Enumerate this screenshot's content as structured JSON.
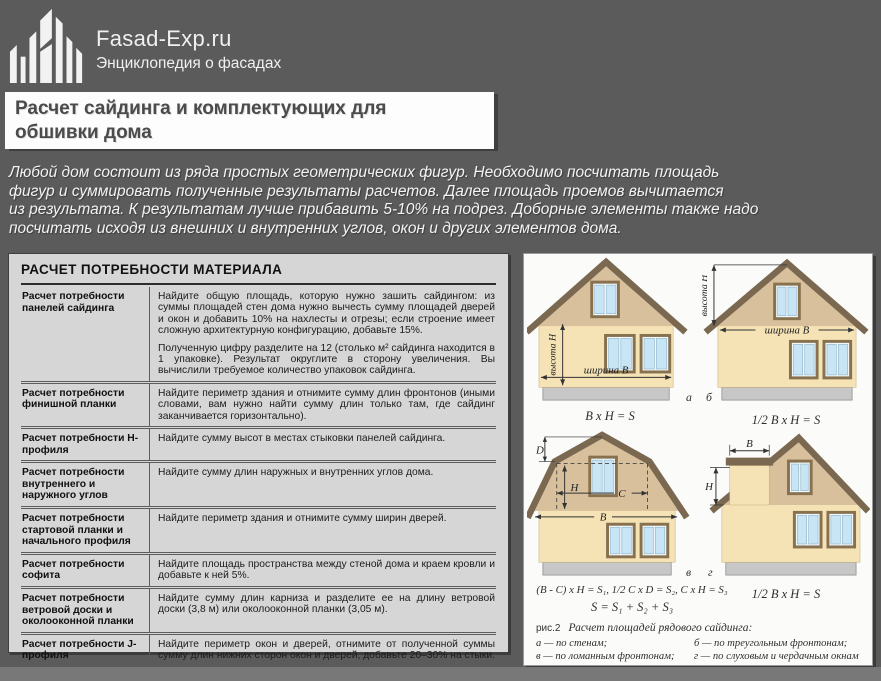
{
  "header": {
    "brand": "Fasad-Exp.ru",
    "tagline": "Энциклопедия о фасадах"
  },
  "title": "Расчет сайдинга и комплектующих для обшивки дома",
  "intro_lines": [
    "Любой дом состоит из ряда простых геометрических фигур. Необходимо посчитать площадь",
    "фигур и суммировать полученные результаты расчетов. Далее площадь проемов вычитается",
    "из результата. К результатам лучше прибавить 5-10% на подрез. Доборные элементы также надо",
    "посчитать исходя из внешних и внутренних углов, окон и других элементов дома."
  ],
  "table": {
    "header": "РАСЧЕТ ПОТРЕБНОСТИ МАТЕРИАЛА",
    "rows": [
      {
        "label": "Расчет потребности панелей сайдинга",
        "text": "Найдите общую площадь, которую нужно зашить сайдингом: из суммы площадей стен дома нужно вычесть сумму площадей дверей и окон и добавить 10% на нахлесты и отрезы; если строение имеет сложную архитектурную конфигурацию, добавьте 15%.",
        "text2": "Полученную цифру разделите на 12 (столько м² сайдинга находится в 1 упаковке). Результат округлите в сторону увеличения. Вы вычислили требуемое количество упаковок сайдинга."
      },
      {
        "label": "Расчет потребности финишной планки",
        "text": "Найдите периметр здания и отнимите сумму длин фронтонов (иными словами, вам нужно найти сумму длин только там, где сайдинг заканчивается горизонтально)."
      },
      {
        "label": "Расчет потребности Н-профиля",
        "text": "Найдите сумму высот в местах стыковки панелей сайдинга."
      },
      {
        "label": "Расчет потребности внутреннего и наружного углов",
        "text": "Найдите сумму длин наружных и внутренних углов дома."
      },
      {
        "label": "Расчет потребности стартовой планки и начального профиля",
        "text": "Найдите периметр здания и отнимите сумму ширин дверей."
      },
      {
        "label": "Расчет потребности софита",
        "text": "Найдите площадь пространства между стеной дома и краем кровли и добавьте к ней 5%."
      },
      {
        "label": "Расчет потребности ветровой доски и околооконной планки",
        "text": "Найдите сумму длин карниза и разделите ее на длину ветровой доски (3,8 м) или околооконной планки (3,05 м)."
      },
      {
        "label": "Расчет потребности J-профиля",
        "text": "Найдите периметр окон и дверей, отнимите от полученной суммы сумму длин нижних сторон окон и дверей, добавьте 20–30% на стыки."
      },
      {
        "label": "Расчет потребности сливной планки",
        "text": "Найдите сумму ширин окон и добавьте ширину боковых планок (J-профиля или околооконной планки)."
      }
    ]
  },
  "diagrams": {
    "a": {
      "letter": "а",
      "height_label": "высота H",
      "width_label": "ширина B",
      "formula": "B x H = S"
    },
    "b": {
      "letter": "б",
      "height_label": "высота H",
      "width_label": "ширина B",
      "formula": "1/2 B x H = S"
    },
    "v": {
      "letter": "в",
      "d": "D",
      "h": "H",
      "c": "C",
      "b": "B",
      "formula1": "(B - C) x H = S₁,  1/2 C x D = S₂,  C x H = S₃",
      "formula2": "S = S₁ + S₂ + S₃"
    },
    "g": {
      "letter": "г",
      "b": "B",
      "h": "H",
      "formula": "1/2 B x H = S"
    },
    "caption": {
      "fig": "рис.2",
      "title": "Расчет площадей рядового сайдинга:",
      "items": [
        "а — по стенам;",
        "б — по треугольным фронтонам;",
        "в — по ломанным фронтонам;",
        "г — по слуховым и чердачным окнам"
      ]
    }
  },
  "colors": {
    "background": "#5b5b5b",
    "panel_left": "#d6d6d6",
    "panel_right": "#fbfbfa",
    "wall": "#f5e3b6",
    "gable": "#d9c09d",
    "roof": "#7b6850",
    "window_glass": "#c7e5f4",
    "foundation": "#c7c7c7"
  }
}
